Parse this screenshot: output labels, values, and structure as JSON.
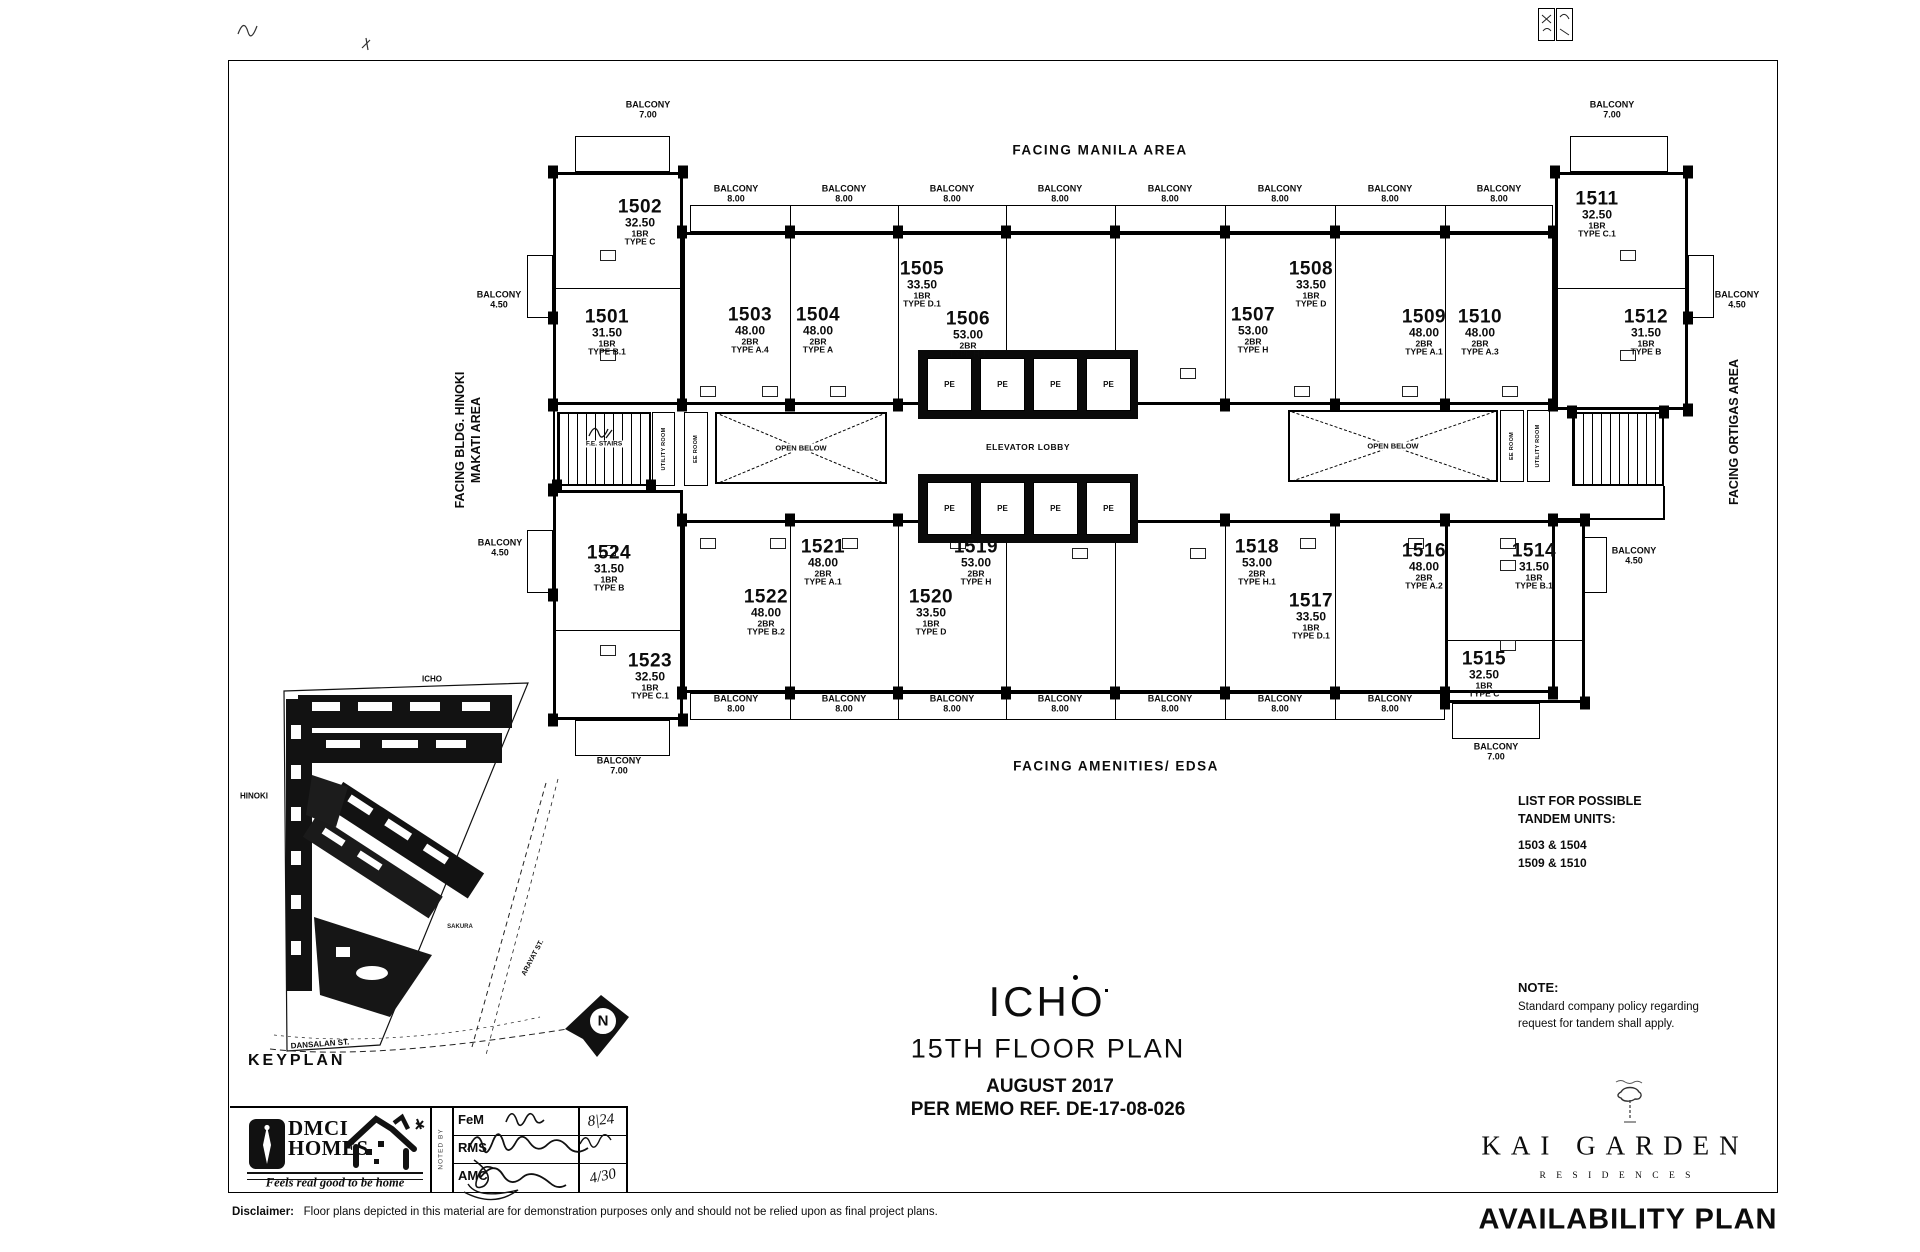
{
  "document": {
    "title": "ICHO",
    "subtitle": "15TH  FLOOR PLAN",
    "date_line": "AUGUST 2017",
    "memo_line": "PER MEMO REF. DE-17-08-026",
    "availability_label": "AVAILABILITY PLAN",
    "disclaimer_label": "Disclaimer:",
    "disclaimer_text": "Floor plans depicted in this material are for demonstration purposes only and should not be relied upon as final project plans."
  },
  "facing": {
    "top": "FACING MANILA AREA",
    "bottom": "FACING AMENITIES/ EDSA",
    "left_line1": "FACING BLDG. HINOKI",
    "left_line2": "MAKATI AREA",
    "right": "FACING ORTIGAS AREA"
  },
  "labels": {
    "balcony": "BALCONY"
  },
  "balconies": {
    "seven": "7.00",
    "eight": "8.00",
    "four_five": "4.50"
  },
  "core": {
    "elevator_lobby": "ELEVATOR LOBBY",
    "pe": "PE",
    "fe_stairs": "F.E. STAIRS",
    "utility": "UTILITY ROOM",
    "ee": "EE ROOM",
    "open_below": "OPEN BELOW"
  },
  "units": [
    {
      "number": "1501",
      "area": "31.50",
      "br": "1BR",
      "type": "TYPE B.1"
    },
    {
      "number": "1502",
      "area": "32.50",
      "br": "1BR",
      "type": "TYPE C"
    },
    {
      "number": "1503",
      "area": "48.00",
      "br": "2BR",
      "type": "TYPE A.4"
    },
    {
      "number": "1504",
      "area": "48.00",
      "br": "2BR",
      "type": "TYPE A"
    },
    {
      "number": "1505",
      "area": "33.50",
      "br": "1BR",
      "type": "TYPE D.1"
    },
    {
      "number": "1506",
      "area": "53.00",
      "br": "2BR",
      "type": "TYPE H.1"
    },
    {
      "number": "1507",
      "area": "53.00",
      "br": "2BR",
      "type": "TYPE H"
    },
    {
      "number": "1508",
      "area": "33.50",
      "br": "1BR",
      "type": "TYPE D"
    },
    {
      "number": "1509",
      "area": "48.00",
      "br": "2BR",
      "type": "TYPE A.1"
    },
    {
      "number": "1510",
      "area": "48.00",
      "br": "2BR",
      "type": "TYPE A.3"
    },
    {
      "number": "1511",
      "area": "32.50",
      "br": "1BR",
      "type": "TYPE C.1"
    },
    {
      "number": "1512",
      "area": "31.50",
      "br": "1BR",
      "type": "TYPE B"
    },
    {
      "number": "1514",
      "area": "31.50",
      "br": "1BR",
      "type": "TYPE B.1"
    },
    {
      "number": "1515",
      "area": "32.50",
      "br": "1BR",
      "type": "TYPE C"
    },
    {
      "number": "1516",
      "area": "48.00",
      "br": "2BR",
      "type": "TYPE A.2"
    },
    {
      "number": "1517",
      "area": "33.50",
      "br": "1BR",
      "type": "TYPE D.1"
    },
    {
      "number": "1518",
      "area": "53.00",
      "br": "2BR",
      "type": "TYPE H.1"
    },
    {
      "number": "1519",
      "area": "53.00",
      "br": "2BR",
      "type": "TYPE H"
    },
    {
      "number": "1520",
      "area": "33.50",
      "br": "1BR",
      "type": "TYPE D"
    },
    {
      "number": "1521",
      "area": "48.00",
      "br": "2BR",
      "type": "TYPE A.1"
    },
    {
      "number": "1522",
      "area": "48.00",
      "br": "2BR",
      "type": "TYPE B.2"
    },
    {
      "number": "1523",
      "area": "32.50",
      "br": "1BR",
      "type": "TYPE C.1"
    },
    {
      "number": "1524",
      "area": "31.50",
      "br": "1BR",
      "type": "TYPE B"
    }
  ],
  "tandem": {
    "heading_line1": "LIST FOR POSSIBLE",
    "heading_line2": "TANDEM UNITS:",
    "pairs": [
      "1503 & 1504",
      "1509 & 1510"
    ]
  },
  "note": {
    "heading": "NOTE:",
    "line1": "Standard company policy regarding",
    "line2": "request for tandem shall apply."
  },
  "keyplan": {
    "title": "KEYPLAN",
    "icho": "ICHO",
    "hinoki": "HINOKI",
    "sakura": "SAKURA",
    "arayat": "ARAYAT ST.",
    "dansalan": "DANSALAN ST.",
    "north": "N"
  },
  "brand": {
    "kai_garden": "KAI GARDEN",
    "residences": "R E S I D E N C E S",
    "dmci_line1": "DMCI",
    "dmci_line2": "HOMES",
    "tagline": "Feels real good to be home"
  },
  "noted_by": {
    "label": "NOTED BY",
    "rows": [
      {
        "who": "FeM",
        "date": "8|24"
      },
      {
        "who": "RMS",
        "date": ""
      },
      {
        "who": "AMC",
        "date": "4/30"
      }
    ]
  }
}
